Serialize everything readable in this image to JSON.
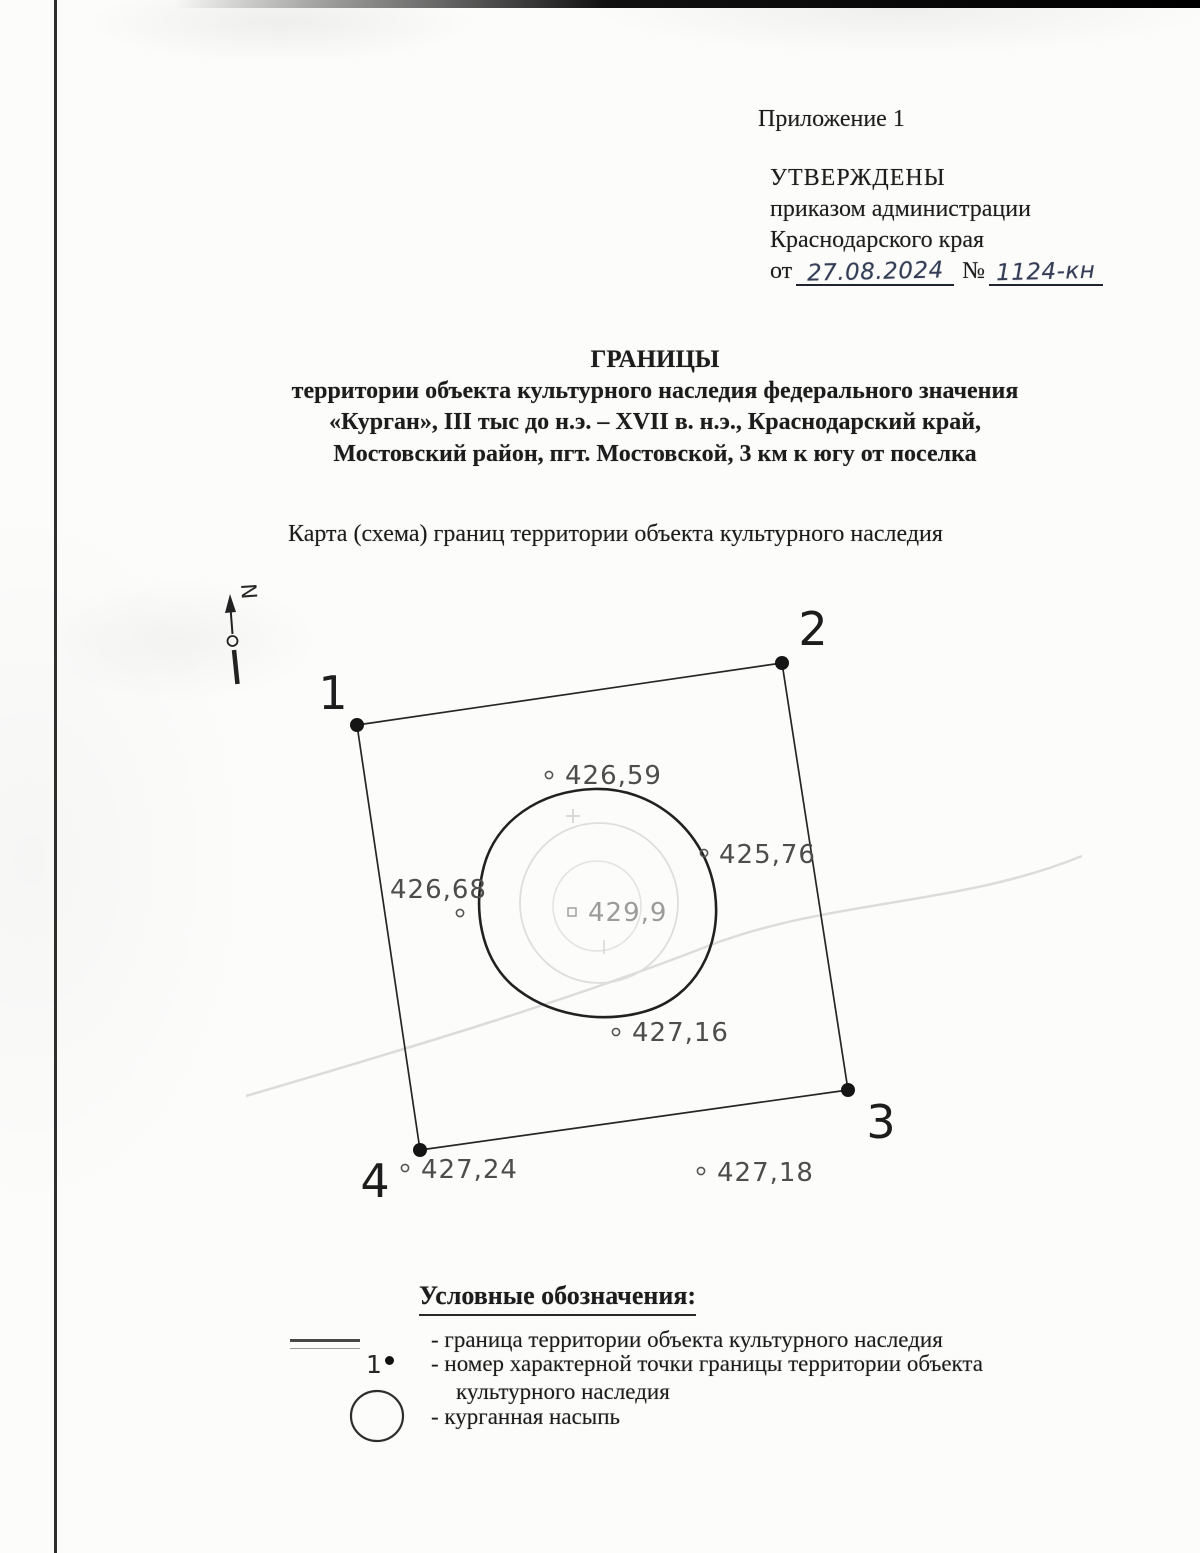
{
  "page": {
    "appendix": "Приложение 1",
    "approval": {
      "line1": "УТВЕРЖДЕНЫ",
      "line2": "приказом администрации",
      "line3": "Краснодарского края",
      "date_label": "от",
      "date_value": "27.08.2024",
      "number_label": "№",
      "number_value": "1124-кн"
    },
    "title": {
      "heading": "ГРАНИЦЫ",
      "line2": "территории объекта культурного наследия федерального значения",
      "line3": "«Курган», III тыс до н.э. – XVII в. н.э., Краснодарский край,",
      "line4": "Мостовский район, пгт. Мостовской, 3 км к югу от поселка"
    },
    "map_caption": "Карта (схема) границ территории объекта культурного наследия"
  },
  "map": {
    "north_label": "N",
    "boundary_points": [
      {
        "label": "1",
        "x": 357,
        "y": 725,
        "label_x": 333,
        "label_y": 709
      },
      {
        "label": "2",
        "x": 782,
        "y": 663,
        "label_x": 813,
        "label_y": 645
      },
      {
        "label": "3",
        "x": 848,
        "y": 1090,
        "label_x": 881,
        "label_y": 1138
      },
      {
        "label": "4",
        "x": 420,
        "y": 1150,
        "label_x": 375,
        "label_y": 1197
      }
    ],
    "elevations": [
      {
        "value": "426,59",
        "marker": "circle",
        "mx": 549,
        "my": 775,
        "tx": 565,
        "ty": 784
      },
      {
        "value": "425,76",
        "marker": "circle",
        "mx": 704,
        "my": 853,
        "tx": 719,
        "ty": 863
      },
      {
        "value": "426,68",
        "marker": "circle",
        "mx": 460,
        "my": 913,
        "tx": 390,
        "ty": 898
      },
      {
        "value": "429,9",
        "marker": "square",
        "mx": 572,
        "my": 912,
        "tx": 588,
        "ty": 921,
        "faded": true
      },
      {
        "value": "427,16",
        "marker": "circle",
        "mx": 616,
        "my": 1032,
        "tx": 632,
        "ty": 1041
      },
      {
        "value": "427,24",
        "marker": "circle",
        "mx": 405,
        "my": 1168,
        "tx": 421,
        "ty": 1178
      },
      {
        "value": "427,18",
        "marker": "circle",
        "mx": 701,
        "my": 1171,
        "tx": 717,
        "ty": 1181
      }
    ]
  },
  "legend": {
    "heading": "Условные обозначения:",
    "items": [
      {
        "symbol": "line",
        "text": "- граница территории объекта культурного наследия"
      },
      {
        "symbol": "point-number",
        "symbol_label": "1",
        "text": "- номер характерной точки границы территории объекта",
        "text2": "культурного наследия"
      },
      {
        "symbol": "circle",
        "text": "- курганная насыпь"
      }
    ]
  }
}
